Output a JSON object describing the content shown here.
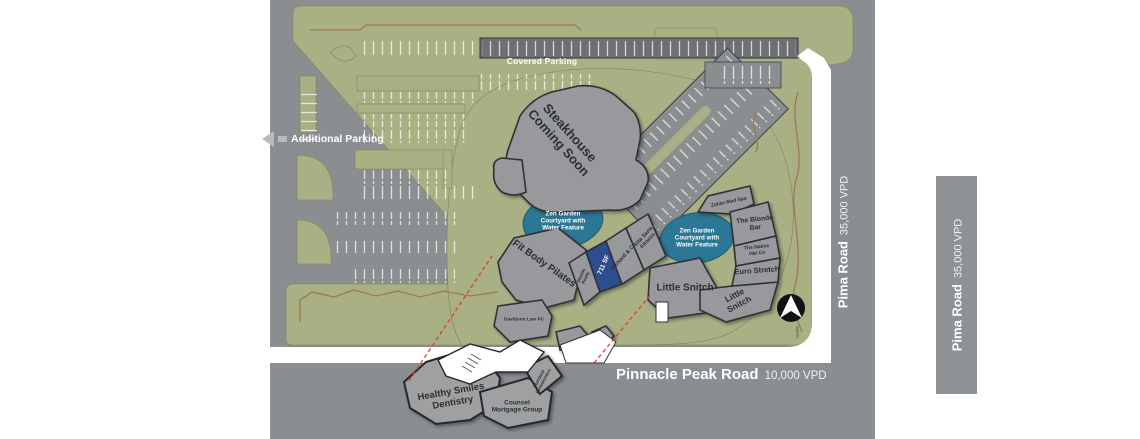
{
  "plan": {
    "parking": {
      "covered": "Covered Parking",
      "additional": "Additional Parking"
    },
    "coming_soon": {
      "line1": "Steakhouse",
      "line2": "Coming Soon"
    },
    "zen_garden": "Zen Garden\nCourtyard with\nWater Feature",
    "tenants": {
      "fit_body": "Fit Body Pilates",
      "shields": "Shields\nRealty",
      "available_space": "711 SF",
      "richard": "Richard & Co",
      "vita": "Vita Sana\nFitness",
      "little_snitch": "Little Snitch",
      "little_snitch_2": "Little\nSnitch",
      "zahav": "Zahav Med Spa",
      "blonde": "The Blonde\nBar",
      "native": "The Native\nHat Co",
      "euro": "Euro Stretch",
      "davidson": "Davidson Law PC",
      "healthy": "Healthy Smiles\nDentistry",
      "counsel": "Counsel\nMortgage Group",
      "standard": "Standard\nPeriodontics"
    },
    "north": "NORTH"
  },
  "roads": {
    "pinnacle": {
      "name": "Pinnacle Peak Road",
      "vpd": "10,000 VPD"
    },
    "pima": {
      "name": "Pima Road",
      "vpd": "35,000 VPD"
    }
  },
  "colors": {
    "landscape_green": "#a9b184",
    "asphalt_gray": "#8b8e90",
    "water_blue": "#2c7796",
    "available_blue": "#2e4d8e",
    "callout_red": "#e23b30"
  }
}
